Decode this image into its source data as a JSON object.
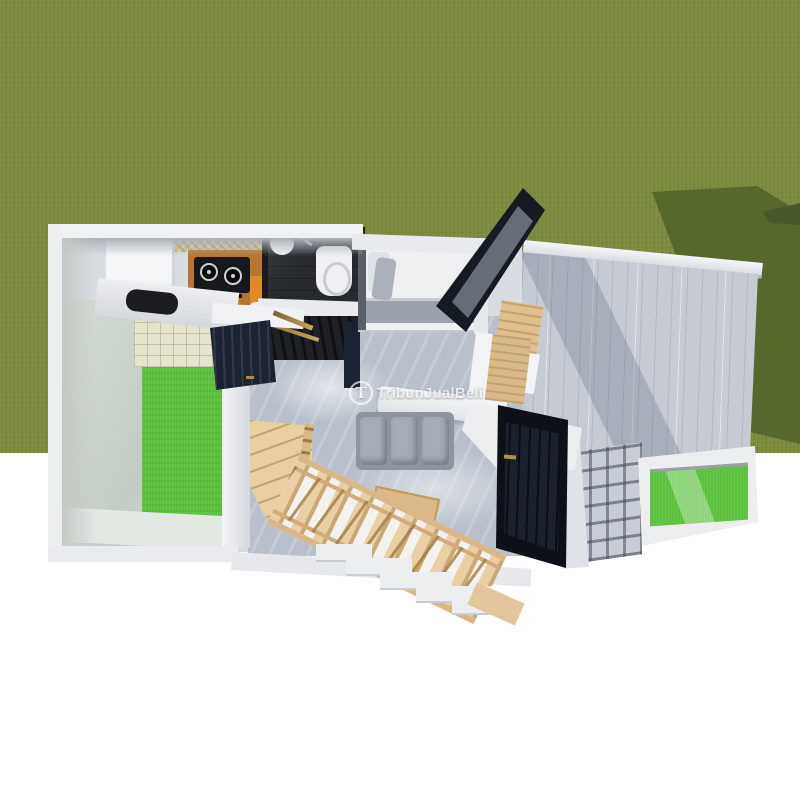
{
  "scene": {
    "description": "Top-down 3D architectural render of a small single-storey house floor plan placed on a grass lawn, between white letterbox bands",
    "rooms": [
      "kitchen",
      "bathroom",
      "bedroom",
      "living-room",
      "indoor-garden-courtyard",
      "carport",
      "planter-box",
      "staircase"
    ]
  },
  "watermark": {
    "text": "TribunJualBeli",
    "logo_letter": "T"
  },
  "palette": {
    "grass": "#7d8b3e",
    "grassShadow": "#56682c",
    "brightGrass": "#5cc13d",
    "concrete": "#c6cad2",
    "marble": "#b9c0cb",
    "navy": "#1b2231",
    "black": "#161a22",
    "counterWood": "#b5772f",
    "backsplashYellow": "#d6c577",
    "tileBeige": "#e6e3cf",
    "gold": "#a98a4a",
    "bedGray": "#9aa1ab"
  }
}
